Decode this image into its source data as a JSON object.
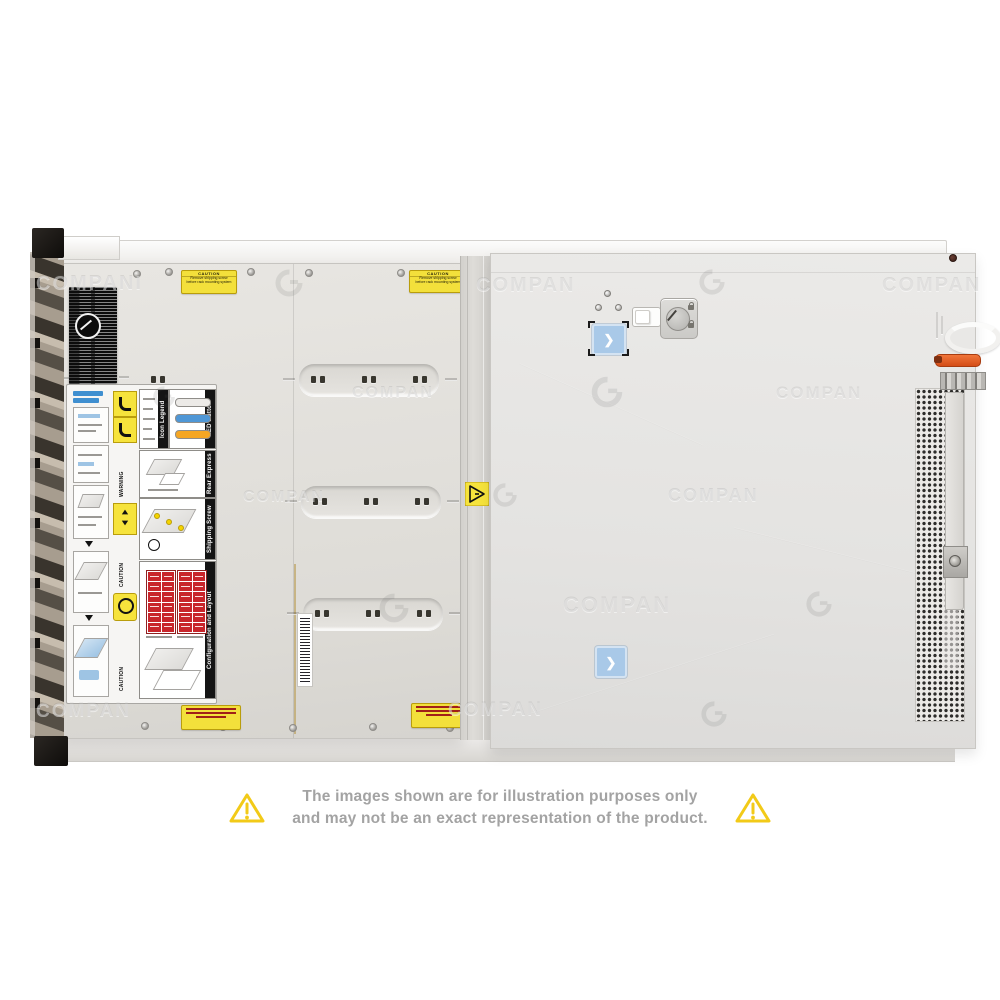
{
  "watermark": {
    "text": "COMPAN",
    "text_long": "COMPANI"
  },
  "disclaimer": {
    "line1": "The images shown are for illustration purposes only",
    "line2": "and may not be an exact representation of the product."
  },
  "stickers": {
    "caution_shipping": {
      "title": "CAUTION",
      "line1": "Remove shipping screw",
      "line2": "before rack mounting system"
    },
    "warning_label": "WARNING",
    "caution_label": "CAUTION"
  },
  "service_panel": {
    "sections": [
      {
        "title": "Icon Legend"
      },
      {
        "title": "LED Button Behavior"
      },
      {
        "title": "Rear Express Service Tag"
      },
      {
        "title": "Shipping Screw Removal"
      },
      {
        "title": "Configuration and Layout"
      }
    ]
  },
  "colors": {
    "accent_blue": "#a9c9e8",
    "warning_yellow": "#f3e03b",
    "alert_red": "#c8252b",
    "orange_lever": "#e05a1e"
  }
}
